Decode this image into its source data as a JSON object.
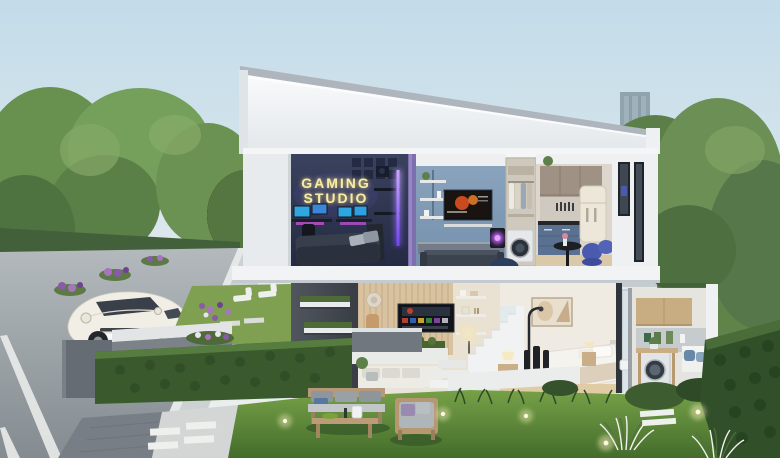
{
  "image": {
    "type": "3d-architectural-cutaway-render",
    "subject": "Two-storey modern house cross-section on a tree-lined street with city skyline"
  },
  "neon_sign": {
    "line1": "GAMING",
    "line2": "STUDIO",
    "glow_color": "#f6e88a"
  },
  "rooms": {
    "upper_floor": [
      "gaming-studio-bedroom",
      "media-lounge",
      "laundry-closet",
      "kitchen-dining"
    ],
    "ground_floor": [
      "side-garden",
      "living-room",
      "staircase",
      "bedroom",
      "utility-laundry"
    ]
  },
  "exterior_elements": [
    "street",
    "white-car",
    "flower-median",
    "hedge-fence",
    "front-lawn",
    "outdoor-lounge-set",
    "garden-lights",
    "city-skyline",
    "park-trees"
  ],
  "colors": {
    "sky_top": "#c3dcea",
    "sky_horizon": "#eaf0ee",
    "roof_white": "#f4f6f8",
    "gaming_wall_navy": "#2b3350",
    "media_wall_blue": "#8099b4",
    "kitchen_cabinet_taupe": "#9f9183",
    "kitchen_base_blue": "#5b7191",
    "wood_slat_wall": "#d9c2a0",
    "feature_wall_gray": "#474c54",
    "hedge_green": "#3a5a2e",
    "lawn_green": "#6f9a44",
    "tree_green": "#6b8f54",
    "road_gray": "#9ba3a8",
    "led_strip_purple": "#8b5cf6",
    "tv_game_orange": "#c8431f",
    "car_white": "#f1eee6"
  }
}
